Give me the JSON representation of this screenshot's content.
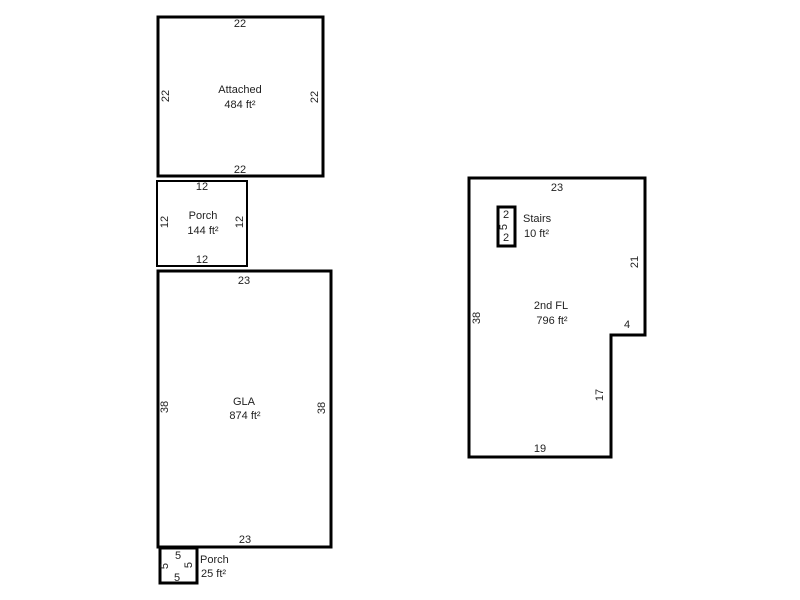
{
  "colors": {
    "background": "#ffffff",
    "line": "#000000",
    "text": "#1f1f1f"
  },
  "first_floor": {
    "attached": {
      "label": "Attached",
      "area": "484 ft²",
      "dim_top": "22",
      "dim_left": "22",
      "dim_right": "22",
      "dim_bottom": "22"
    },
    "porch": {
      "label": "Porch",
      "area": "144 ft²",
      "dim_top": "12",
      "dim_left": "12",
      "dim_right": "12",
      "dim_bottom": "12"
    },
    "gla": {
      "label": "GLA",
      "area": "874 ft²",
      "dim_top": "23",
      "dim_left": "38",
      "dim_right": "38",
      "dim_bottom": "23"
    },
    "small_porch": {
      "label": "Porch",
      "area": "25 ft²",
      "dim_top": "5",
      "dim_left": "5",
      "dim_right": "5",
      "dim_bottom": "5"
    }
  },
  "second_floor": {
    "main": {
      "label": "2nd FL",
      "area": "796 ft²",
      "dim_top": "23",
      "dim_left": "38",
      "dim_right_upper": "21",
      "dim_notch": "4",
      "dim_right_lower": "17",
      "dim_bottom": "19"
    },
    "stairs": {
      "label": "Stairs",
      "area": "10 ft²",
      "dim_top": "2",
      "dim_side": "5",
      "dim_bottom": "2"
    }
  }
}
